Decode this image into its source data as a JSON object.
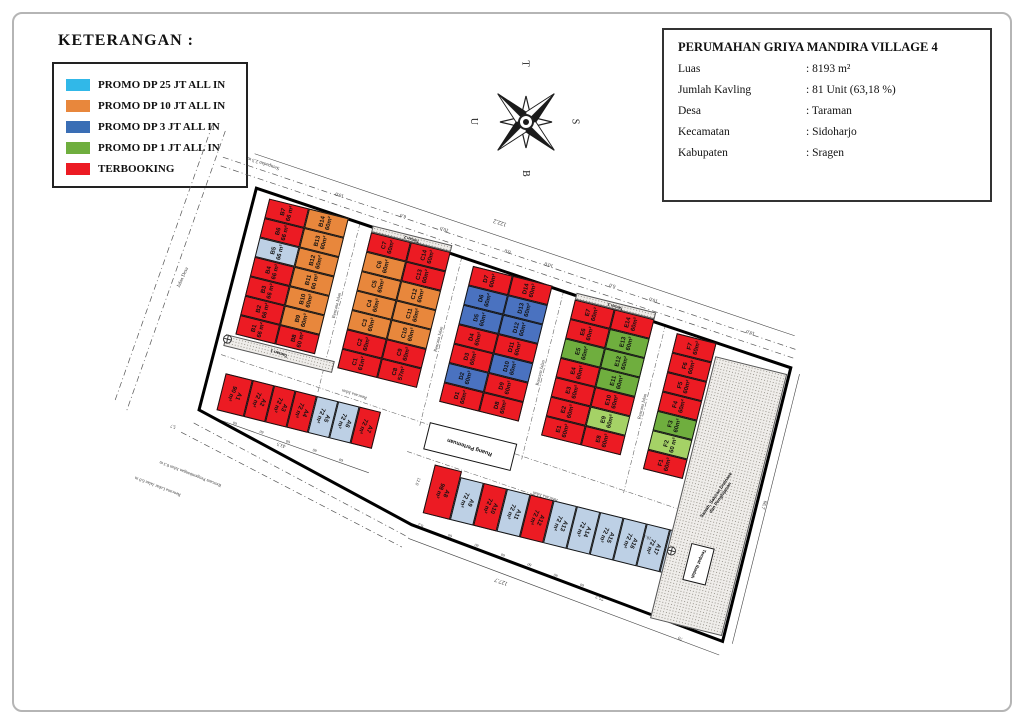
{
  "legend": {
    "title": "KETERANGAN :",
    "items": [
      {
        "label": "PROMO DP 25 JT ALL IN",
        "color": "#31b8e8"
      },
      {
        "label": "PROMO DP 10 JT ALL IN",
        "color": "#e8873c"
      },
      {
        "label": "PROMO DP 3 JT ALL IN",
        "color": "#3a6eb5"
      },
      {
        "label": "PROMO DP 1 JT ALL IN",
        "color": "#6fae3e"
      },
      {
        "label": "TERBOOKING",
        "color": "#ec1b23"
      }
    ]
  },
  "info_box": {
    "title": "PERUMAHAN GRIYA MANDIRA VILLAGE 4",
    "rows": [
      {
        "label": "Luas",
        "value": ": 8193 m²"
      },
      {
        "label": "Jumlah Kavling",
        "value": ": 81 Unit (63,18 %)"
      },
      {
        "label": "Desa",
        "value": ": Taraman"
      },
      {
        "label": "Kecamatan",
        "value": ": Sidoharjo"
      },
      {
        "label": "Kabupaten",
        "value": ": Sragen"
      }
    ]
  },
  "compass": {
    "top": "T",
    "left": "U",
    "right": "S",
    "bottom": "B"
  },
  "site_plan": {
    "status_colors": {
      "terbooking": "#ec1b23",
      "promo10": "#e8873c",
      "promo3": "#4a72c0",
      "promo1": "#6fae3e",
      "promo1l": "#a5d266",
      "available": "#bdd0e5",
      "facility": "#ffffff"
    },
    "blocks": [
      {
        "name": "B",
        "columns": [
          [
            {
              "id": "B7",
              "area": "66 m²",
              "status": "terbooking"
            },
            {
              "id": "B6",
              "area": "66 m²",
              "status": "terbooking"
            },
            {
              "id": "B5",
              "area": "66 m²",
              "status": "available"
            },
            {
              "id": "B4",
              "area": "66 m²",
              "status": "terbooking"
            },
            {
              "id": "B3",
              "area": "66 m²",
              "status": "terbooking"
            },
            {
              "id": "B2",
              "area": "66 m²",
              "status": "terbooking"
            },
            {
              "id": "B1",
              "area": "66 m²",
              "status": "terbooking"
            }
          ],
          [
            {
              "id": "B14",
              "area": "60m²",
              "status": "promo10"
            },
            {
              "id": "B13",
              "area": "60m²",
              "status": "promo10"
            },
            {
              "id": "B12",
              "area": "60m²",
              "status": "promo10"
            },
            {
              "id": "B11",
              "area": "60 m²",
              "status": "promo10"
            },
            {
              "id": "B10",
              "area": "60m²",
              "status": "promo10"
            },
            {
              "id": "B9",
              "area": "60m²",
              "status": "promo10"
            },
            {
              "id": "B8",
              "area": "60 m²",
              "status": "terbooking"
            }
          ]
        ]
      },
      {
        "name": "C",
        "columns": [
          [
            {
              "id": "C7",
              "area": "60m²",
              "status": "terbooking"
            },
            {
              "id": "C6",
              "area": "60m²",
              "status": "promo10"
            },
            {
              "id": "C5",
              "area": "60m²",
              "status": "promo10"
            },
            {
              "id": "C4",
              "area": "60m²",
              "status": "promo10"
            },
            {
              "id": "C3",
              "area": "60m²",
              "status": "promo10"
            },
            {
              "id": "C2",
              "area": "60m²",
              "status": "terbooking"
            },
            {
              "id": "C1",
              "area": "61m²",
              "status": "terbooking"
            }
          ],
          [
            {
              "id": "C14",
              "area": "60m²",
              "status": "terbooking"
            },
            {
              "id": "C13",
              "area": "60m²",
              "status": "terbooking"
            },
            {
              "id": "C12",
              "area": "60m²",
              "status": "promo10"
            },
            {
              "id": "C11",
              "area": "60m²",
              "status": "promo10"
            },
            {
              "id": "C10",
              "area": "60m²",
              "status": "promo10"
            },
            {
              "id": "C9",
              "area": "60m²",
              "status": "terbooking"
            },
            {
              "id": "C8",
              "area": "57m²",
              "status": "terbooking"
            }
          ]
        ]
      },
      {
        "name": "D",
        "columns": [
          [
            {
              "id": "D7",
              "area": "60m²",
              "status": "terbooking"
            },
            {
              "id": "D6",
              "area": "60m²",
              "status": "promo3"
            },
            {
              "id": "D5",
              "area": "60m²",
              "status": "promo3"
            },
            {
              "id": "D4",
              "area": "60m²",
              "status": "terbooking"
            },
            {
              "id": "D3",
              "area": "60m²",
              "status": "terbooking"
            },
            {
              "id": "D2",
              "area": "60m²",
              "status": "promo3"
            },
            {
              "id": "D1",
              "area": "60m²",
              "status": "terbooking"
            }
          ],
          [
            {
              "id": "D14",
              "area": "60m²",
              "status": "terbooking"
            },
            {
              "id": "D13",
              "area": "60m²",
              "status": "promo3"
            },
            {
              "id": "D12",
              "area": "60m²",
              "status": "promo3"
            },
            {
              "id": "D11",
              "area": "60m²",
              "status": "terbooking"
            },
            {
              "id": "D10",
              "area": "60m²",
              "status": "promo3"
            },
            {
              "id": "D9",
              "area": "60m²",
              "status": "terbooking"
            },
            {
              "id": "D8",
              "area": "60m²",
              "status": "terbooking"
            }
          ]
        ]
      },
      {
        "name": "E",
        "columns": [
          [
            {
              "id": "E7",
              "area": "60m²",
              "status": "terbooking"
            },
            {
              "id": "E6",
              "area": "60m²",
              "status": "terbooking"
            },
            {
              "id": "E5",
              "area": "60m²",
              "status": "promo1"
            },
            {
              "id": "E4",
              "area": "60m²",
              "status": "terbooking"
            },
            {
              "id": "E3",
              "area": "60m²",
              "status": "terbooking"
            },
            {
              "id": "E2",
              "area": "60m²",
              "status": "terbooking"
            },
            {
              "id": "E1",
              "area": "60m²",
              "status": "terbooking"
            }
          ],
          [
            {
              "id": "E14",
              "area": "60m²",
              "status": "terbooking"
            },
            {
              "id": "E13",
              "area": "60m²",
              "status": "promo1"
            },
            {
              "id": "E12",
              "area": "60m²",
              "status": "promo1"
            },
            {
              "id": "E11",
              "area": "60m²",
              "status": "promo1"
            },
            {
              "id": "E10",
              "area": "60m²",
              "status": "terbooking"
            },
            {
              "id": "E9",
              "area": "60m²",
              "status": "promo1l"
            },
            {
              "id": "E8",
              "area": "60m²",
              "status": "terbooking"
            }
          ]
        ]
      },
      {
        "name": "F",
        "columns": [
          [
            {
              "id": "F7",
              "area": "60m²",
              "status": "terbooking"
            },
            {
              "id": "F6",
              "area": "60m²",
              "status": "terbooking"
            },
            {
              "id": "F5",
              "area": "60m²",
              "status": "terbooking"
            },
            {
              "id": "F4",
              "area": "60m²",
              "status": "terbooking"
            },
            {
              "id": "F3",
              "area": "60m²",
              "status": "promo1"
            },
            {
              "id": "F2",
              "area": "60 m²",
              "status": "promo1l"
            },
            {
              "id": "F1",
              "area": "60m²",
              "status": "terbooking"
            }
          ]
        ]
      }
    ],
    "a_row": [
      {
        "id": "A1",
        "area": "90 m²",
        "status": "terbooking"
      },
      {
        "id": "A2",
        "area": "72 m²",
        "status": "terbooking"
      },
      {
        "id": "A3",
        "area": "72 m²",
        "status": "terbooking"
      },
      {
        "id": "A4",
        "area": "72 m²",
        "status": "terbooking"
      },
      {
        "id": "A5",
        "area": "72 m²",
        "status": "available"
      },
      {
        "id": "A6",
        "area": "72 m²",
        "status": "available"
      },
      {
        "id": "A7",
        "area": "72 m²",
        "status": "terbooking"
      }
    ],
    "a_strip": [
      {
        "id": "A8",
        "area": "98 m²",
        "status": "terbooking"
      },
      {
        "id": "A9",
        "area": "72 m²",
        "status": "available"
      },
      {
        "id": "A10",
        "area": "72 m²",
        "status": "terbooking"
      },
      {
        "id": "A11",
        "area": "72 m²",
        "status": "available"
      },
      {
        "id": "A12",
        "area": "72 m²",
        "status": "terbooking"
      },
      {
        "id": "A13",
        "area": "72 m²",
        "status": "available"
      },
      {
        "id": "A14",
        "area": "72 m²",
        "status": "available"
      },
      {
        "id": "A15",
        "area": "72 m²",
        "status": "available"
      },
      {
        "id": "A16",
        "area": "72 m²",
        "status": "available"
      },
      {
        "id": "A17",
        "area": "72 m²",
        "status": "available"
      },
      {
        "id": "A18",
        "area": "72m²",
        "status": "available"
      }
    ],
    "facilities": {
      "meeting_room": "Ruang Pertemuan",
      "worship": "Tempat Ibadah",
      "park1": "Taman 1",
      "park2": "Taman 2",
      "park3": "Taman 3",
      "surroundings": "Sawah, Saluran Drainase\ndan Penghijauan"
    },
    "annotations": [
      {
        "t": "Sempadan 2.5 m",
        "x": 14,
        "y": -26,
        "r": 184,
        "s": 5
      },
      {
        "t": "122.2",
        "x": 268,
        "y": -26,
        "r": 184,
        "s": 6
      },
      {
        "t": "10.0",
        "x": 108,
        "y": -14,
        "r": 184,
        "s": 5
      },
      {
        "t": "6.0",
        "x": 176,
        "y": -9,
        "r": 184,
        "s": 5
      },
      {
        "t": "10.0",
        "x": 218,
        "y": -6,
        "r": 184,
        "s": 5
      },
      {
        "t": "6.0",
        "x": 286,
        "y": 0,
        "r": 184,
        "s": 5
      },
      {
        "t": "10.0",
        "x": 328,
        "y": 3,
        "r": 184,
        "s": 5
      },
      {
        "t": "6.0",
        "x": 396,
        "y": 8,
        "r": 184,
        "s": 5
      },
      {
        "t": "10.0",
        "x": 438,
        "y": 12,
        "r": 184,
        "s": 5
      },
      {
        "t": "10.0",
        "x": 540,
        "y": 20,
        "r": 184,
        "s": 5
      },
      {
        "t": "Jalan Desa",
        "x": -30,
        "y": 105,
        "r": -80,
        "s": 5
      },
      {
        "t": "Rencana Jalan",
        "x": 123,
        "y": 95,
        "r": -90,
        "s": 4.5
      },
      {
        "t": "Rencana Jalan",
        "x": 230,
        "y": 103,
        "r": -90,
        "s": 4.5
      },
      {
        "t": "Rencana Jalan",
        "x": 337,
        "y": 111,
        "r": -90,
        "s": 4.5
      },
      {
        "t": "Rencana Jalan",
        "x": 444,
        "y": 119,
        "r": -90,
        "s": 4.5
      },
      {
        "t": "Rencana Jalan",
        "x": 162,
        "y": 177,
        "r": 184,
        "s": 4.5
      },
      {
        "t": "Rencana Jalan",
        "x": 372,
        "y": 230,
        "r": 184,
        "s": 4.5
      },
      {
        "t": "43.5",
        "x": 112,
        "y": 243,
        "r": 184,
        "s": 5
      },
      {
        "t": "60",
        "x": 64,
        "y": 234,
        "r": 184,
        "s": 4
      },
      {
        "t": "60",
        "x": 92,
        "y": 236,
        "r": 184,
        "s": 4
      },
      {
        "t": "60",
        "x": 120,
        "y": 239,
        "r": 184,
        "s": 4
      },
      {
        "t": "60",
        "x": 148,
        "y": 241,
        "r": 184,
        "s": 4
      },
      {
        "t": "60",
        "x": 176,
        "y": 244,
        "r": 184,
        "s": 4
      },
      {
        "t": "12.0",
        "x": 254,
        "y": 246,
        "r": 96,
        "s": 4.5
      },
      {
        "t": "8.2",
        "x": 268,
        "y": 288,
        "r": 186,
        "s": 4.5
      },
      {
        "t": "60",
        "x": 300,
        "y": 291,
        "r": 186,
        "s": 4
      },
      {
        "t": "60",
        "x": 328,
        "y": 294,
        "r": 186,
        "s": 4
      },
      {
        "t": "60",
        "x": 356,
        "y": 297,
        "r": 186,
        "s": 4
      },
      {
        "t": "60",
        "x": 384,
        "y": 300,
        "r": 186,
        "s": 4
      },
      {
        "t": "60",
        "x": 412,
        "y": 304,
        "r": 186,
        "s": 4
      },
      {
        "t": "60",
        "x": 440,
        "y": 307,
        "r": 186,
        "s": 4
      },
      {
        "t": "127.7",
        "x": 356,
        "y": 322,
        "r": 186,
        "s": 6
      },
      {
        "t": "75.2",
        "x": 458,
        "y": 314,
        "r": 186,
        "s": 5
      },
      {
        "t": "70",
        "x": 548,
        "y": 334,
        "r": 186,
        "s": 5
      },
      {
        "t": "18.1",
        "x": 490,
        "y": 245,
        "r": 184,
        "s": 4.5
      },
      {
        "t": "66.7",
        "x": 594,
        "y": 185,
        "r": 96,
        "s": 5
      },
      {
        "t": "5.7",
        "x": 4,
        "y": 252,
        "r": 184,
        "s": 4.5
      },
      {
        "t": "Rencana Pengembangan Jalan 0.3 m",
        "x": 2,
        "y": 294,
        "r": 187,
        "s": 4.5
      },
      {
        "t": "Rencana Lebar Jalan 6.0 m",
        "x": -18,
        "y": 314,
        "r": 187,
        "s": 4.5
      }
    ]
  }
}
